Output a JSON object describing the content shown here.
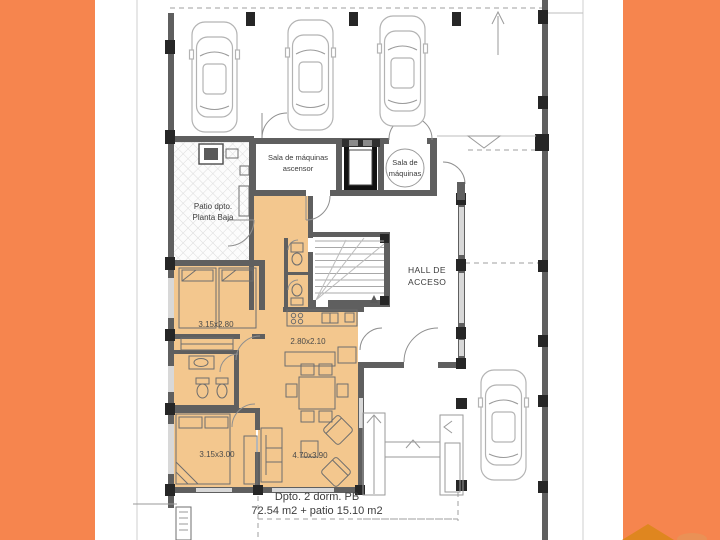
{
  "colors": {
    "band_orange": "#f6854e",
    "room_fill": "#f3c78e",
    "wall_gray": "#5f5f5f",
    "column_black": "#262626",
    "logo_orange": "#df861f"
  },
  "plan": {
    "machine_room_elevator": {
      "line1": "Sala de máquinas",
      "line2": "ascensor"
    },
    "machine_room": {
      "line1": "Sala de",
      "line2": "máquinas"
    },
    "patio": {
      "line1": "Patio dpto.",
      "line2": "Planta Baja"
    },
    "hall": {
      "line1": "HALL DE",
      "line2": "ACCESO"
    },
    "dimensions": {
      "bedroom1": "3.15x2.80",
      "kitchen": "2.80x2.10",
      "bedroom2": "3.15x3.00",
      "living": "4.70x3.90"
    },
    "summary": {
      "line1": "Dpto. 2 dorm. PB",
      "line2": "72.54 m2 + patio 15.10 m2"
    }
  }
}
